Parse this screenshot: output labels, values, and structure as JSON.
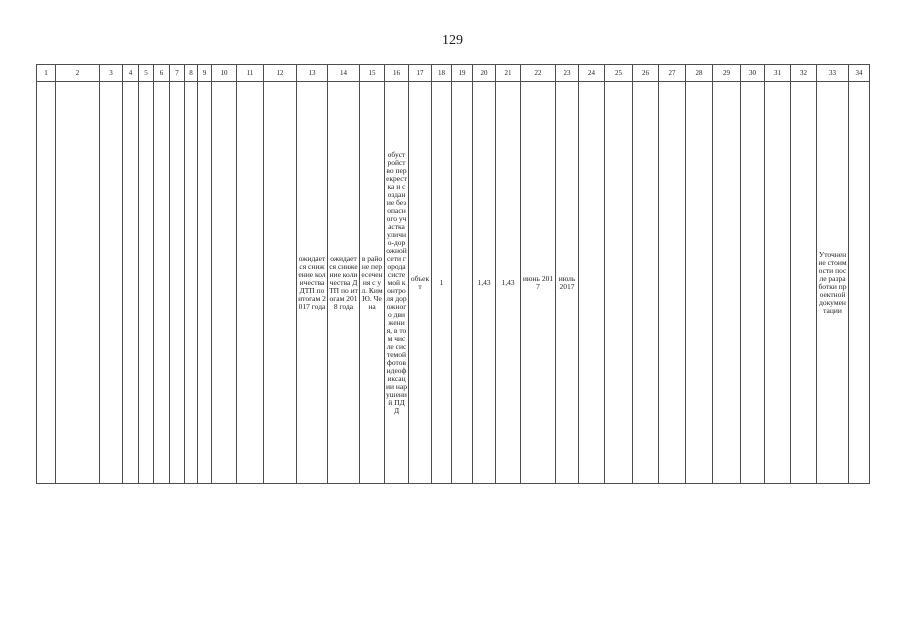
{
  "page": {
    "number": "129"
  },
  "table": {
    "headers": [
      "1",
      "2",
      "3",
      "4",
      "5",
      "6",
      "7",
      "8",
      "9",
      "10",
      "11",
      "12",
      "13",
      "14",
      "15",
      "16",
      "17",
      "18",
      "19",
      "20",
      "21",
      "22",
      "23",
      "24",
      "25",
      "26",
      "27",
      "28",
      "29",
      "30",
      "31",
      "32",
      "33",
      "34"
    ],
    "cells": [
      "",
      "",
      "",
      "",
      "",
      "",
      "",
      "",
      "",
      "",
      "",
      "",
      "ожидается снижение количества ДТП по итогам 2017 года",
      "ожидается снижение количества ДТП по итогам 2018 года",
      "в районе пересечения с ул. Ким Ю. Чена",
      "обустройство перекрестка и создание безопасного участка улично-дорожной сети города системой контроля дорожного движения, в том числе системой фотовидеофиксации нарушений ПДД",
      "объект",
      "1",
      "",
      "1,43",
      "1,43",
      "июнь 2017",
      "июль 2017",
      "",
      "",
      "",
      "",
      "",
      "",
      "",
      "",
      "",
      "Уточнение стоимости после разработки проектной документации",
      ""
    ]
  }
}
